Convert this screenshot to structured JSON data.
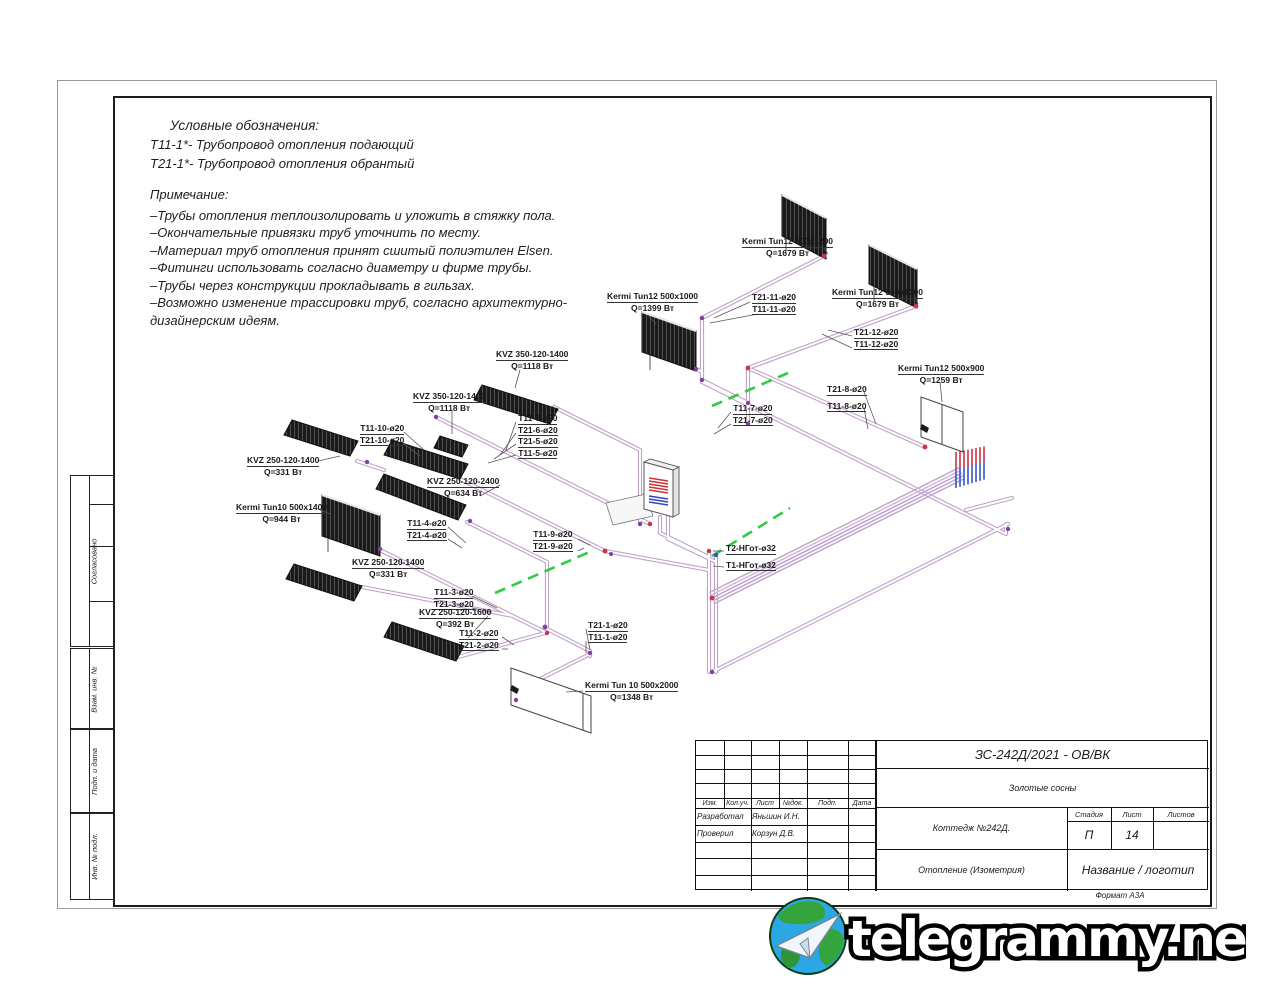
{
  "legend": {
    "title": "Условные обозначения:",
    "items": [
      "Т11-1*-  Трубопровод отопления подающий",
      "Т21-1*-  Трубопровод отопления обрантый"
    ]
  },
  "notes": {
    "title": "Примечание:",
    "items": [
      "–Трубы отопления теплоизолировать и уложить в стяжку пола.",
      "–Окончательные привязки труб уточнить по месту.",
      "–Материал труб отопления принят сшитый полиэтилен Elsen.",
      "–Фитинги использовать согласно диаметру и фирме трубы.",
      "–Трубы через конструкции прокладывать в гильзах.",
      "–Возможно изменение трассировки труб, согласно архитектурно-дизайнерским идеям."
    ]
  },
  "diagram": {
    "labels": [
      {
        "lines": [
          "Kermi Tun12 500x1200",
          "Q=1679 Вт"
        ]
      },
      {
        "lines": [
          "Т21-11-ø20",
          "Т11-11-ø20"
        ]
      },
      {
        "lines": [
          "Kermi Tun12 500x1200",
          "Q=1679 Вт"
        ]
      },
      {
        "lines": [
          "Т21-12-ø20",
          "Т11-12-ø20"
        ]
      },
      {
        "lines": [
          "Kermi Tun12 500x1000",
          "Q=1399 Вт"
        ]
      },
      {
        "lines": [
          "KVZ 350-120-1400",
          "Q=1118 Вт"
        ]
      },
      {
        "lines": [
          "KVZ 350-120-1400",
          "Q=1118 Вт"
        ]
      },
      {
        "lines": [
          "Т11-6-ø20",
          "Т21-6-ø20",
          "Т21-5-ø20",
          "Т11-5-ø20"
        ]
      },
      {
        "lines": [
          "Т11-10-ø20",
          "Т21-10-ø20"
        ]
      },
      {
        "lines": [
          "KVZ 250-120-1400",
          "Q=331 Вт"
        ]
      },
      {
        "lines": [
          "KVZ 250-120-2400",
          "Q=634 Вт"
        ]
      },
      {
        "lines": [
          "Kermi Tun10 500x1400",
          "Q=944 Вт"
        ]
      },
      {
        "lines": [
          "Т11-4-ø20",
          "Т21-4-ø20"
        ]
      },
      {
        "lines": [
          "Т11-9-ø20",
          "Т21-9-ø20"
        ]
      },
      {
        "lines": [
          "Kermi Tun12 500x900",
          "Q=1259 Вт"
        ]
      },
      {
        "lines": [
          "Т21-8-ø20",
          "Т11-8-ø20"
        ]
      },
      {
        "lines": [
          "Т11-7-ø20",
          "Т21-7-ø20"
        ]
      },
      {
        "lines": [
          "KVZ 250-120-1400",
          "Q=331 Вт"
        ]
      },
      {
        "lines": [
          "Т2-НГот-ø32",
          "Т1-НГот-ø32"
        ]
      },
      {
        "lines": [
          "Т11-3-ø20",
          "Т21-3-ø20"
        ]
      },
      {
        "lines": [
          "KVZ 250-120-1600",
          "Q=392 Вт"
        ]
      },
      {
        "lines": [
          "Т11-2-ø20",
          "Т21-2-ø20"
        ]
      },
      {
        "lines": [
          "Т21-1-ø20",
          "Т11-1-ø20"
        ]
      },
      {
        "lines": [
          "Kermi Tun 10 500x2000",
          "Q=1348 Вт"
        ]
      }
    ],
    "colors": {
      "pipe": "#bfa3c8",
      "supply_accent": "#cc3344",
      "return_accent": "#3355cc",
      "valve_dashes": "#2ecc40",
      "junction": "#8040a0"
    }
  },
  "side_stamps": {
    "approved": "Согласовано",
    "replace_inv": "Взам. инв. №",
    "sign_date": "Подп. и дата",
    "inv_orig": "Инв. № подл."
  },
  "title_block": {
    "doc_code": "ЗС-242Д/2021 - ОВ/ВК",
    "project": "Золотые сосны",
    "object": "Коттедж №242Д.",
    "drawing_title": "Отопление (Изометрия)",
    "company": "Название / логотип",
    "cols": {
      "izm": "Изм.",
      "koluch": "Кол.уч.",
      "list": "Лист",
      "ndok": "№док.",
      "podp": "Подп.",
      "data": "Дата"
    },
    "stage_label": "Стадия",
    "sheet_label": "Лист",
    "sheets_label": "Листов",
    "stage": "П",
    "sheet": "14",
    "sheets": "",
    "developed_label": "Разработал",
    "developed_name": "Яньшин И.Н.",
    "checked_label": "Проверил",
    "checked_name": "Корзун Д.В.",
    "format": "Формат А3А"
  },
  "watermark": {
    "text": "telegrammy.net"
  }
}
